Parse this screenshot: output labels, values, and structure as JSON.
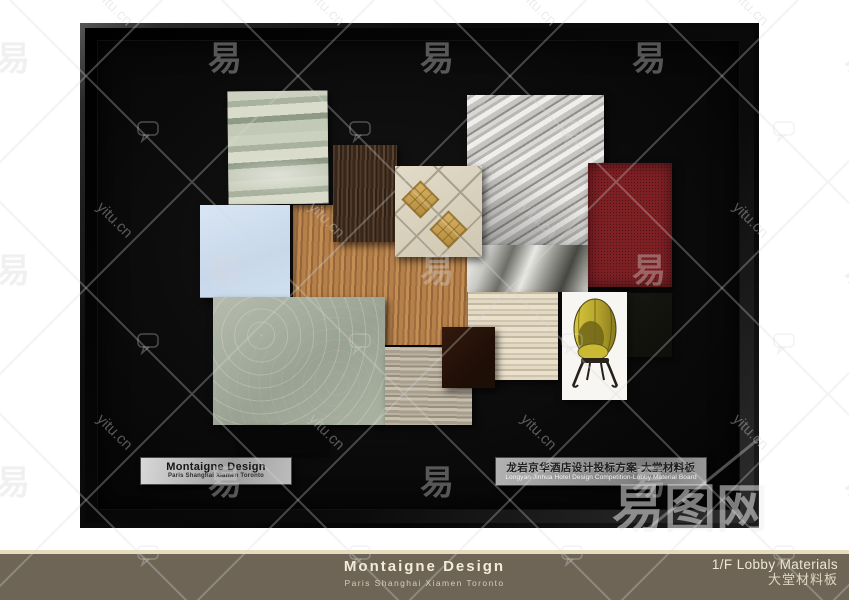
{
  "board": {
    "plaque_left": {
      "title": "Montaigne Design",
      "subtitle": "Paris Shanghai Xiamen Toronto"
    },
    "plaque_right": {
      "title_zh": "龙岩京华酒店设计投标方案-大堂材料板",
      "subtitle_en": "Longyan Jinhua Hotel Design Competition-Lobby Material Board"
    },
    "materials": [
      {
        "name": "green-onyx-marble",
        "color": "#b7bead"
      },
      {
        "name": "walnut-wood-veneer",
        "color": "#3f2d1f"
      },
      {
        "name": "oak-wood-veneer",
        "color": "#ad7a46"
      },
      {
        "name": "culture-stone-cladding",
        "color": "#c6c5c2"
      },
      {
        "name": "abstract-grey-marble",
        "color": "#9a9a94"
      },
      {
        "name": "beige-ceramic-floor-tile",
        "color": "#d8d1bd"
      },
      {
        "name": "gold-mosaic-inlay",
        "color": "#c49f50"
      },
      {
        "name": "sky-blue-laminate",
        "color": "#cfe0f0"
      },
      {
        "name": "red-carpet",
        "color": "#7d2024"
      },
      {
        "name": "floral-pattern-wallcovering",
        "color": "#a8b1a0"
      },
      {
        "name": "grey-travertine-stone",
        "color": "#aba294"
      },
      {
        "name": "beige-travertine-stone",
        "color": "#dcd2bd"
      },
      {
        "name": "dark-chocolate-laminate",
        "color": "#241209"
      },
      {
        "name": "yellow-canopy-chair-photo",
        "color": "#bfae2c"
      },
      {
        "name": "dark-fabric-swatch",
        "color": "#14120e"
      },
      {
        "name": "black-leather-swatch",
        "color": "#070707"
      }
    ]
  },
  "footer": {
    "brand": "Montaigne Design",
    "cities": "Paris  Shanghai  Xiamen  Toronto",
    "right_title": "1/F Lobby Materials",
    "right_subtitle": "大堂材料板"
  },
  "watermark": {
    "tile_text": "易",
    "url_text": "yitu.cn",
    "logo_text": "易图网"
  },
  "colors": {
    "footer_bar": "#6e6557",
    "footer_accent_line": "#e8dcbe",
    "footer_text": "#f2ecd8",
    "frame": "#0d0d0d",
    "board_background": "#0a0a0a",
    "carpet_red": "#7d2024",
    "chair_yellow": "#bfae2c"
  }
}
